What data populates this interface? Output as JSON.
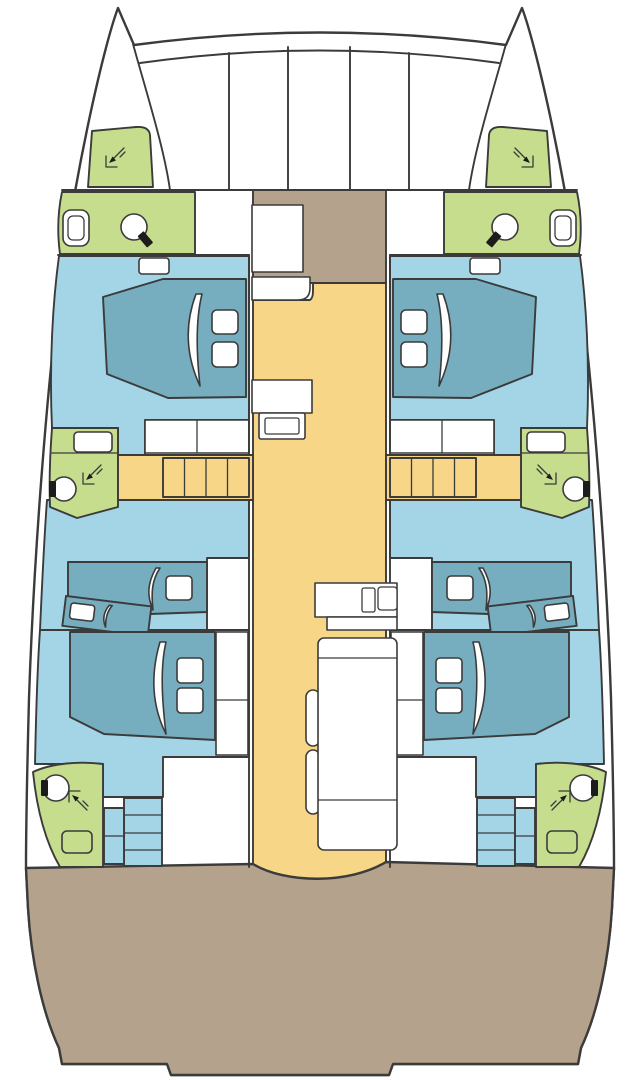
{
  "meta": {
    "diagram_type": "catamaran-deck-plan",
    "view": "top-down, bow at top",
    "symmetry": "port-starboard mirrored hulls"
  },
  "colors": {
    "background": "#ffffff",
    "outline": "#3b3b3b",
    "hull": "#ffffff",
    "cabin_floor": "#a3d5e6",
    "bed": "#76aec0",
    "bathroom": "#c6dd8e",
    "corridor": "#f8d687",
    "deck": "#b4a28c",
    "fixture": "#ffffff",
    "tap": "#1c1c1c"
  },
  "layout": {
    "center_zones": [
      "trampoline",
      "foredeck",
      "saloon",
      "nav-station",
      "galley",
      "settee",
      "aft-cockpit"
    ],
    "per_hull_zones": [
      "bow-shower-room",
      "forward-head",
      "forward-cabin",
      "mid-head",
      "companionway-stairs",
      "mid-cabin",
      "aft-cabin",
      "aft-head",
      "aft-stairs"
    ]
  },
  "features": {
    "double_berths": 4,
    "single_berths": 4,
    "bathroom_zones": 8,
    "stair_flights": 4,
    "trampoline_panels": 5
  },
  "icons": {
    "shower": "corner-spray-arrow",
    "sink": "basin-circle-with-tap",
    "toilet": "rounded-rect-bowl",
    "stairs": "treaded-steps",
    "berth": "mattress-with-pillows-and-sheet-fold"
  }
}
